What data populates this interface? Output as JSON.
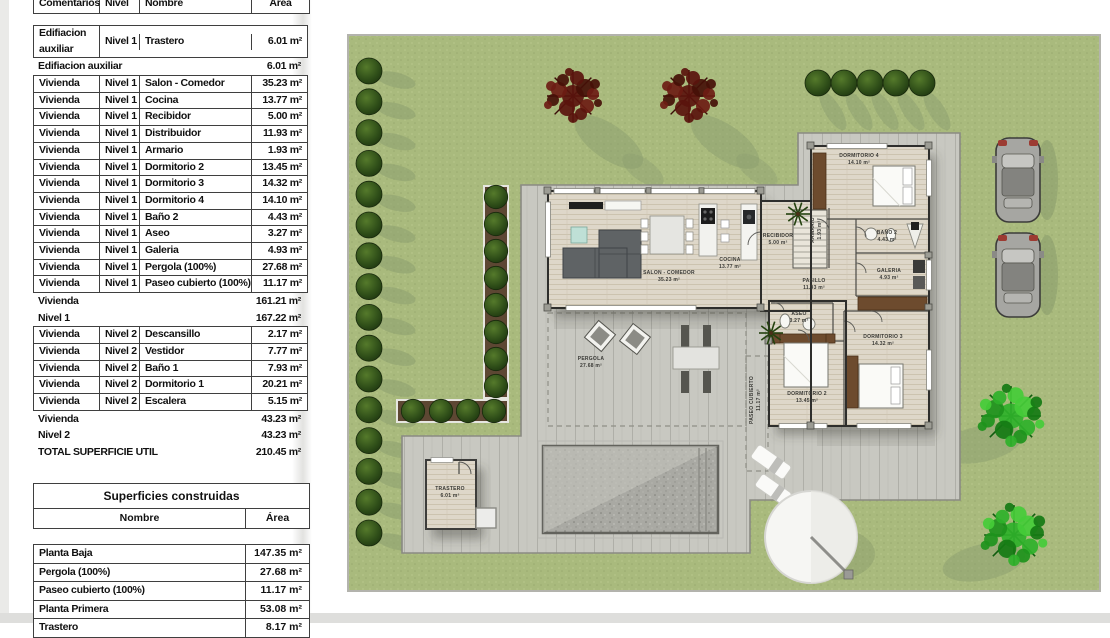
{
  "surface_table": {
    "headers": {
      "comentarios": "Comentarios",
      "nivel": "Nivel",
      "nombre": "Nombre",
      "area": "Área"
    },
    "blocks": [
      {
        "type": "rows",
        "rows": [
          [
            "Edifiacion auxiliar",
            "Nivel 1",
            "Trastero",
            "6.01 m²"
          ]
        ]
      },
      {
        "type": "sub",
        "label": "Edifiacion auxiliar",
        "value": "6.01 m²"
      },
      {
        "type": "rows",
        "rows": [
          [
            "Vivienda",
            "Nivel 1",
            "Salon - Comedor",
            "35.23 m²"
          ],
          [
            "Vivienda",
            "Nivel 1",
            "Cocina",
            "13.77 m²"
          ],
          [
            "Vivienda",
            "Nivel 1",
            "Recibidor",
            "5.00 m²"
          ],
          [
            "Vivienda",
            "Nivel 1",
            "Distribuidor",
            "11.93 m²"
          ],
          [
            "Vivienda",
            "Nivel 1",
            "Armario",
            "1.93 m²"
          ],
          [
            "Vivienda",
            "Nivel 1",
            "Dormitorio 2",
            "13.45 m²"
          ],
          [
            "Vivienda",
            "Nivel 1",
            "Dormitorio 3",
            "14.32 m²"
          ],
          [
            "Vivienda",
            "Nivel 1",
            "Dormitorio 4",
            "14.10 m²"
          ],
          [
            "Vivienda",
            "Nivel 1",
            "Baño 2",
            "4.43 m²"
          ],
          [
            "Vivienda",
            "Nivel 1",
            "Aseo",
            "3.27 m²"
          ],
          [
            "Vivienda",
            "Nivel 1",
            "Galeria",
            "4.93 m²"
          ],
          [
            "Vivienda",
            "Nivel 1",
            "Pergola (100%)",
            "27.68 m²"
          ],
          [
            "Vivienda",
            "Nivel 1",
            "Paseo cubierto (100%)",
            "11.17 m²"
          ]
        ]
      },
      {
        "type": "sub",
        "label": "Vivienda",
        "value": "161.21 m²"
      },
      {
        "type": "sub",
        "label": "Nivel 1",
        "value": "167.22 m²"
      },
      {
        "type": "rows",
        "rows": [
          [
            "Vivienda",
            "Nivel 2",
            "Descansillo",
            "2.17 m²"
          ],
          [
            "Vivienda",
            "Nivel 2",
            "Vestidor",
            "7.77 m²"
          ],
          [
            "Vivienda",
            "Nivel 2",
            "Baño 1",
            "7.93 m²"
          ],
          [
            "Vivienda",
            "Nivel 2",
            "Dormitorio 1",
            "20.21 m²"
          ],
          [
            "Vivienda",
            "Nivel 2",
            "Escalera",
            "5.15 m²"
          ]
        ]
      },
      {
        "type": "sub",
        "label": "Vivienda",
        "value": "43.23 m²"
      },
      {
        "type": "sub",
        "label": "Nivel 2",
        "value": "43.23 m²"
      },
      {
        "type": "sub",
        "label": "TOTAL SUPERFICIE UTIL",
        "value": "210.45 m²"
      }
    ]
  },
  "construidas_table": {
    "title": "Superficies construidas",
    "headers": {
      "nombre": "Nombre",
      "area": "Área"
    },
    "rows": [
      [
        "Planta Baja",
        "147.35 m²"
      ],
      [
        "Pergola (100%)",
        "27.68 m²"
      ],
      [
        "Paseo cubierto (100%)",
        "11.17 m²"
      ],
      [
        "Planta Primera",
        "53.08 m²"
      ],
      [
        "Trastero",
        "8.17 m²"
      ]
    ]
  },
  "plan": {
    "rooms": {
      "salon": {
        "name": "SALON - COMEDOR",
        "area": "35.23 m²"
      },
      "cocina": {
        "name": "COCINA",
        "area": "13.77 m²"
      },
      "recibidor": {
        "name": "RECIBIDOR",
        "area": "5.00 m²"
      },
      "armario": {
        "name": "ARMARIO",
        "area": "1.93 m²"
      },
      "pasillo": {
        "name": "PASILLO",
        "area": "11.93 m²"
      },
      "dormitorio4": {
        "name": "DORMITORIO 4",
        "area": "14.10 m²"
      },
      "bano2": {
        "name": "BAÑO 2",
        "area": "4.43 m²"
      },
      "galeria": {
        "name": "GALERIA",
        "area": "4.93 m²"
      },
      "dormitorio3": {
        "name": "DORMITORIO 3",
        "area": "14.32 m²"
      },
      "dormitorio2": {
        "name": "DORMITORIO 2",
        "area": "13.45 m²"
      },
      "aseo": {
        "name": "ASEO",
        "area": "3.27 m²"
      },
      "pergola": {
        "name": "PERGOLA",
        "area": "27.68 m²"
      },
      "paseo_cubierto": {
        "name": "PASEO CUBIERTO",
        "area": "11.17 m²"
      },
      "trastero": {
        "name": "TRASTERO",
        "area": "6.01 m²"
      }
    },
    "colors": {
      "grass": "#a9ba7d",
      "deck": "#c8c8c1",
      "floor": "#ded7c9",
      "wall": "#2e2e2c",
      "bush": "#2e4d18",
      "bright_tree": "#2fb12a",
      "autumn_tree": "#5a130d",
      "pool": "#a9a9a3"
    }
  }
}
